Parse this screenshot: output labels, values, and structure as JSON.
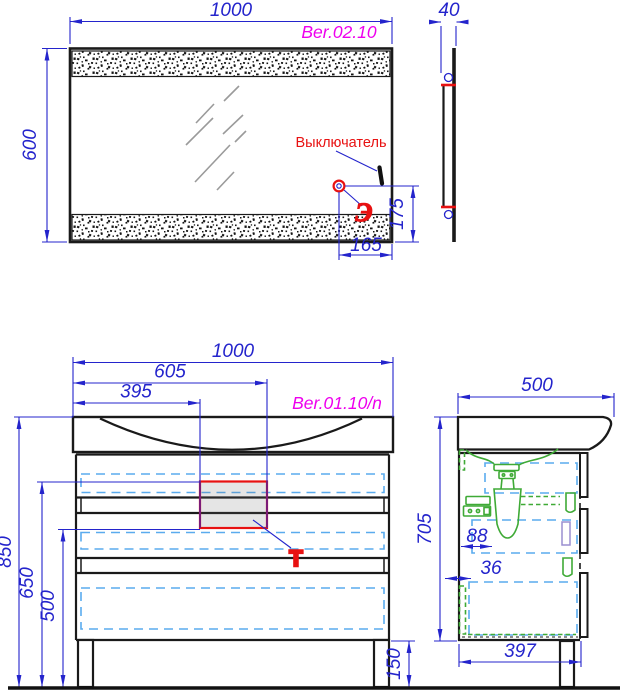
{
  "views": {
    "mirror_front": {
      "model": "Ber.02.10",
      "width": "1000",
      "height": "600",
      "switch_label": "Выключатель",
      "outlet_offset_h": "165",
      "outlet_offset_v": "175",
      "electric_symbol": "Э"
    },
    "mirror_side": {
      "depth": "40"
    },
    "cabinet_front": {
      "model": "Ber.01.10/n",
      "width": "1000",
      "opening_right": "605",
      "opening_left": "395",
      "height_total": "850",
      "opening_top": "650",
      "opening_bottom": "500",
      "legs_height": "150",
      "water_symbol": "Т"
    },
    "cabinet_side": {
      "depth": "500",
      "height": "705",
      "siphon_offset": "88",
      "back_gap": "36",
      "body_depth": "397"
    }
  },
  "colors": {
    "dimension_blue": "#2424cc",
    "model_magenta": "#ee00ee",
    "alert_red": "#e81111",
    "hidden_cyan": "#5aabee",
    "fitting_green": "#3faa36"
  }
}
